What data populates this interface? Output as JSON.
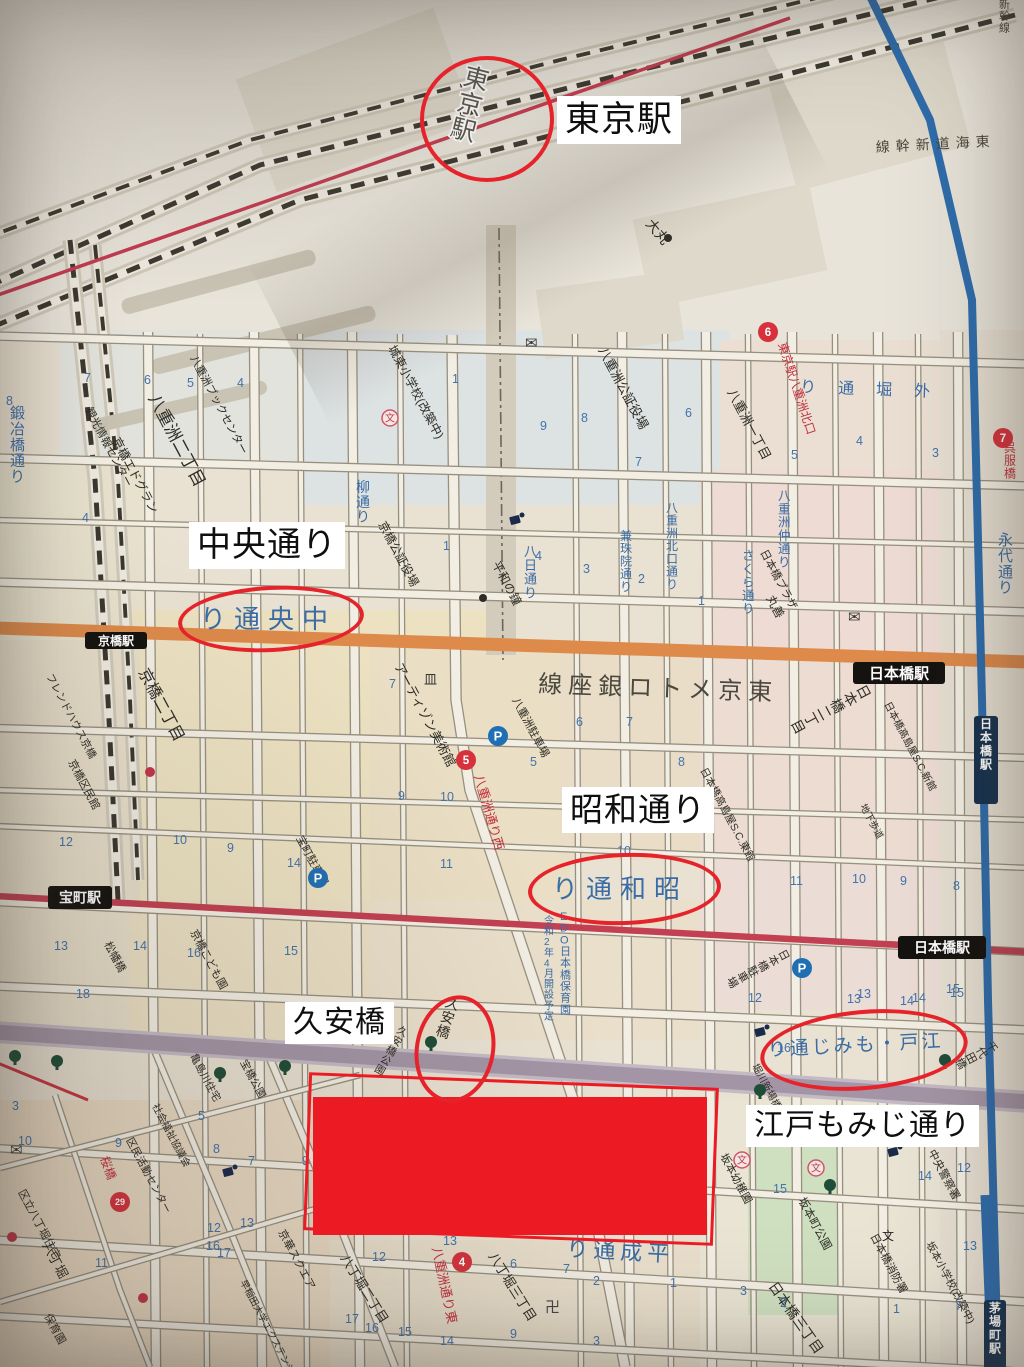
{
  "annotations": {
    "tokyo_station": "東京駅",
    "chuo_dori": "中央通り",
    "showa_dori": "昭和通り",
    "kyuan_bashi": "久安橋",
    "edo_momiji_dori": "江戸もみじ通り"
  },
  "colors": {
    "annotation_red": "#e6232b",
    "redaction_red": "#ec1a23",
    "road_orange": "#dd8a4b",
    "line_crimson": "#c24052",
    "expressway_purple": "#a495a6",
    "line_blue": "#2e6cac",
    "label_blue": "#3a6ca6",
    "label_black": "#2e2c26",
    "label_red": "#c2303c",
    "paper": "#e9e1d2"
  },
  "map": {
    "stations": [
      {
        "t": "京橋駅",
        "x": 85,
        "y": 632,
        "w": 62,
        "h": 17,
        "fs": 12
      },
      {
        "t": "日本橋駅",
        "x": 853,
        "y": 662,
        "w": 92,
        "h": 22,
        "fs": 15
      },
      {
        "t": "宝町駅",
        "x": 48,
        "y": 886,
        "w": 64,
        "h": 23,
        "fs": 14
      },
      {
        "t": "日本橋駅",
        "x": 898,
        "y": 936,
        "w": 88,
        "h": 23,
        "fs": 14
      },
      {
        "t": "日本橋駅",
        "x": 974,
        "y": 716,
        "w": 24,
        "h": 88,
        "fs": 12,
        "v": 1,
        "bg": "#16324f"
      },
      {
        "t": "茅場町駅",
        "x": 984,
        "y": 1300,
        "w": 22,
        "h": 80,
        "fs": 12,
        "v": 1,
        "bg": "#16324f"
      }
    ],
    "blue_labels": [
      {
        "t": "中央通り",
        "x": 200,
        "y": 628,
        "fs": 26,
        "rtl": 1,
        "ls": 8
      },
      {
        "t": "昭和通り",
        "x": 552,
        "y": 898,
        "fs": 26,
        "rtl": 1,
        "ls": 8
      },
      {
        "t": "江戸・もみじ通り",
        "x": 768,
        "y": 1056,
        "fs": 19,
        "rtl": 1,
        "ls": 3,
        "r": -3
      },
      {
        "t": "外堀通り",
        "x": 800,
        "y": 392,
        "fs": 16,
        "rtl": 1,
        "ls": 22,
        "r": 2
      },
      {
        "t": "平成通り",
        "x": 566,
        "y": 1256,
        "fs": 22,
        "rtl": 1,
        "ls": 5,
        "r": 3
      },
      {
        "t": "鍛冶橋通り",
        "x": 10,
        "y": 418,
        "fs": 15,
        "v": 1
      },
      {
        "t": "柳通り",
        "x": 356,
        "y": 492,
        "fs": 14,
        "v": 1
      },
      {
        "t": "八日通り",
        "x": 524,
        "y": 556,
        "fs": 13,
        "v": 1
      },
      {
        "t": "兼珠院通り",
        "x": 620,
        "y": 540,
        "fs": 12,
        "v": 1
      },
      {
        "t": "八重洲北口通り",
        "x": 666,
        "y": 512,
        "fs": 12,
        "v": 1
      },
      {
        "t": "さくら通り",
        "x": 742,
        "y": 560,
        "fs": 12.5,
        "v": 1
      },
      {
        "t": "八重洲仲通り",
        "x": 778,
        "y": 500,
        "fs": 12.5,
        "v": 1
      },
      {
        "t": "永代通り",
        "x": 998,
        "y": 545,
        "fs": 15,
        "v": 1
      },
      {
        "t": "EDO日本橋保育園",
        "x": 560,
        "y": 920,
        "fs": 11,
        "v": 1
      },
      {
        "t": "令和2年4月開設予定",
        "x": 544,
        "y": 924,
        "fs": 10,
        "v": 1
      }
    ],
    "dark_labels": [
      {
        "t": "東京メトロ銀座線",
        "x": 538,
        "y": 692,
        "fs": 24,
        "rtl": 1,
        "ls": 6,
        "r": 2
      },
      {
        "t": "東海道新幹線",
        "x": 876,
        "y": 152,
        "fs": 14,
        "rtl": 1,
        "ls": 6,
        "r": -3
      },
      {
        "t": "新幹線",
        "x": 999,
        "y": 8,
        "fs": 11,
        "v": 1
      },
      {
        "t": "東京駅",
        "x": 462,
        "y": 84,
        "fs": 25,
        "v": 1,
        "o": 1,
        "r": 14
      }
    ],
    "red_labels": [
      {
        "t": "東京駅八重洲北口",
        "x": 778,
        "y": 344,
        "fs": 12,
        "r": 72
      },
      {
        "t": "八重洲通り西",
        "x": 474,
        "y": 776,
        "fs": 13,
        "r": 74
      },
      {
        "t": "八重洲通り東",
        "x": 432,
        "y": 1248,
        "fs": 13,
        "r": 78
      },
      {
        "t": "桜橋",
        "x": 100,
        "y": 1158,
        "fs": 12,
        "r": 70
      },
      {
        "t": "呉服橋",
        "x": 1004,
        "y": 452,
        "fs": 12,
        "v": 1
      }
    ],
    "poi_labels": [
      {
        "t": "八重洲二丁目",
        "x": 148,
        "y": 398,
        "fs": 17
      },
      {
        "t": "八重洲ブックセンター",
        "x": 190,
        "y": 358,
        "fs": 11
      },
      {
        "t": "城東小学校(改築中)",
        "x": 388,
        "y": 348,
        "fs": 12
      },
      {
        "t": "八重洲公証役場",
        "x": 598,
        "y": 350,
        "fs": 13
      },
      {
        "t": "八重洲一丁目",
        "x": 727,
        "y": 392,
        "fs": 13
      },
      {
        "t": "大丸",
        "x": 645,
        "y": 224,
        "fs": 14,
        "r": 50
      },
      {
        "t": "観光情報センター",
        "x": 85,
        "y": 410,
        "fs": 11
      },
      {
        "t": "京橋エドグラン",
        "x": 112,
        "y": 440,
        "fs": 12
      },
      {
        "t": "京橋公証役場",
        "x": 378,
        "y": 524,
        "fs": 12
      },
      {
        "t": "平和の鐘",
        "x": 492,
        "y": 564,
        "fs": 12
      },
      {
        "t": "フレンドハウス京橋",
        "x": 46,
        "y": 676,
        "fs": 10.5
      },
      {
        "t": "京橋二丁目",
        "x": 138,
        "y": 672,
        "fs": 16
      },
      {
        "t": "京橋区民館",
        "x": 68,
        "y": 762,
        "fs": 11
      },
      {
        "t": "アーティゾン美術館",
        "x": 394,
        "y": 666,
        "fs": 13
      },
      {
        "t": "八重洲駐車場",
        "x": 512,
        "y": 700,
        "fs": 11
      },
      {
        "t": "宝町駐車場",
        "x": 296,
        "y": 838,
        "fs": 11
      },
      {
        "t": "日本橋プラザ",
        "x": 760,
        "y": 552,
        "fs": 11
      },
      {
        "t": "丸善",
        "x": 766,
        "y": 598,
        "fs": 12
      },
      {
        "t": "日本橋二丁目",
        "x": 856,
        "y": 688,
        "fs": 14,
        "v": 1
      },
      {
        "t": "日本橋高島屋S.C.新館",
        "x": 884,
        "y": 704,
        "fs": 10
      },
      {
        "t": "日本橋高島屋S.C.東館",
        "x": 700,
        "y": 770,
        "fs": 10.5
      },
      {
        "t": "地下歩道",
        "x": 860,
        "y": 806,
        "fs": 9.5
      },
      {
        "t": "日本橋駐車場",
        "x": 778,
        "y": 952,
        "fs": 11,
        "v": 1
      },
      {
        "t": "京橋こども園",
        "x": 190,
        "y": 932,
        "fs": 11
      },
      {
        "t": "松幡橋",
        "x": 104,
        "y": 944,
        "fs": 11
      },
      {
        "t": "久安橋",
        "x": 444,
        "y": 1006,
        "fs": 14,
        "r": 18,
        "v": 1
      },
      {
        "t": "久安橋公園",
        "x": 396,
        "y": 1032,
        "fs": 10.5,
        "r": 30,
        "v": 1
      },
      {
        "t": "宝橋公園",
        "x": 240,
        "y": 1062,
        "fs": 10.5
      },
      {
        "t": "亀島川住宅",
        "x": 190,
        "y": 1056,
        "fs": 10.5
      },
      {
        "t": "社会福祉協議会",
        "x": 152,
        "y": 1106,
        "fs": 10
      },
      {
        "t": "区民活動センター",
        "x": 126,
        "y": 1140,
        "fs": 10.5
      },
      {
        "t": "区立八丁堀住宅",
        "x": 18,
        "y": 1192,
        "fs": 11
      },
      {
        "t": "八丁堀",
        "x": 42,
        "y": 1245,
        "fs": 13
      },
      {
        "t": "保育園",
        "x": 44,
        "y": 1316,
        "fs": 11
      },
      {
        "t": "京華スクエア",
        "x": 278,
        "y": 1232,
        "fs": 11
      },
      {
        "t": "早稲田大学エクステンションセンター",
        "x": 240,
        "y": 1282,
        "fs": 9.5
      },
      {
        "t": "八丁堀二丁目",
        "x": 340,
        "y": 1258,
        "fs": 13,
        "r": 58
      },
      {
        "t": "八丁堀三丁目",
        "x": 488,
        "y": 1256,
        "fs": 13,
        "r": 58
      },
      {
        "t": "日本橋三丁目",
        "x": 768,
        "y": 1286,
        "fs": 14,
        "r": 55
      },
      {
        "t": "坂本幼稚園",
        "x": 720,
        "y": 1156,
        "fs": 11
      },
      {
        "t": "坂本町公園",
        "x": 798,
        "y": 1200,
        "fs": 11.5
      },
      {
        "t": "坂本小学校(改築中)",
        "x": 926,
        "y": 1244,
        "fs": 10.5
      },
      {
        "t": "日本橋消防署",
        "x": 870,
        "y": 1236,
        "fs": 11
      },
      {
        "t": "中央警察署",
        "x": 928,
        "y": 1152,
        "fs": 11
      },
      {
        "t": "千代田橋",
        "x": 986,
        "y": 1044,
        "fs": 11,
        "v": 1
      },
      {
        "t": "堀川新場橋公園",
        "x": 752,
        "y": 1066,
        "fs": 10
      }
    ],
    "red_badges": [
      [
        "5",
        466,
        760
      ],
      [
        "4",
        462,
        1262
      ],
      [
        "6",
        768,
        332
      ],
      [
        "7",
        1003,
        438
      ],
      [
        "29",
        120,
        1202
      ]
    ],
    "parking_badges": [
      [
        318,
        878
      ],
      [
        498,
        736
      ],
      [
        802,
        968
      ]
    ],
    "block_numbers": [
      [
        8,
        6,
        405
      ],
      [
        7,
        84,
        382
      ],
      [
        6,
        144,
        384
      ],
      [
        5,
        187,
        387
      ],
      [
        4,
        237,
        387
      ],
      [
        4,
        82,
        522
      ],
      [
        1,
        452,
        383
      ],
      [
        9,
        540,
        430
      ],
      [
        8,
        581,
        422
      ],
      [
        7,
        635,
        466
      ],
      [
        6,
        685,
        417
      ],
      [
        5,
        791,
        459
      ],
      [
        4,
        856,
        445
      ],
      [
        3,
        932,
        457
      ],
      [
        4,
        535,
        560
      ],
      [
        3,
        583,
        573
      ],
      [
        2,
        638,
        583
      ],
      [
        1,
        698,
        605
      ],
      [
        1,
        443,
        550
      ],
      [
        7,
        389,
        688
      ],
      [
        9,
        398,
        800
      ],
      [
        10,
        440,
        801
      ],
      [
        5,
        530,
        766
      ],
      [
        6,
        576,
        726
      ],
      [
        7,
        626,
        726
      ],
      [
        8,
        678,
        766
      ],
      [
        11,
        440,
        868
      ],
      [
        10,
        617,
        855
      ],
      [
        12,
        59,
        846
      ],
      [
        10,
        173,
        844
      ],
      [
        9,
        227,
        852
      ],
      [
        14,
        287,
        867
      ],
      [
        13,
        54,
        950
      ],
      [
        14,
        133,
        950
      ],
      [
        16,
        187,
        957
      ],
      [
        15,
        284,
        955
      ],
      [
        18,
        76,
        998
      ],
      [
        11,
        790,
        885
      ],
      [
        10,
        852,
        883
      ],
      [
        9,
        900,
        885
      ],
      [
        8,
        953,
        890
      ],
      [
        13,
        857,
        998
      ],
      [
        14,
        912,
        1002
      ],
      [
        15,
        950,
        997
      ],
      [
        12,
        748,
        1002
      ],
      [
        13,
        847,
        1003
      ],
      [
        14,
        900,
        1005
      ],
      [
        15,
        946,
        993
      ],
      [
        16,
        777,
        1052
      ],
      [
        3,
        12,
        1110
      ],
      [
        10,
        18,
        1145
      ],
      [
        5,
        198,
        1120
      ],
      [
        8,
        213,
        1153
      ],
      [
        7,
        248,
        1165
      ],
      [
        9,
        302,
        1165
      ],
      [
        13,
        240,
        1227
      ],
      [
        12,
        207,
        1232
      ],
      [
        16,
        206,
        1250
      ],
      [
        17,
        217,
        1257
      ],
      [
        11,
        95,
        1267
      ],
      [
        9,
        115,
        1147
      ],
      [
        12,
        372,
        1261
      ],
      [
        13,
        443,
        1245
      ],
      [
        15,
        398,
        1336
      ],
      [
        14,
        440,
        1345
      ],
      [
        16,
        365,
        1332
      ],
      [
        17,
        345,
        1323
      ],
      [
        6,
        510,
        1268
      ],
      [
        9,
        510,
        1338
      ],
      [
        1,
        670,
        1287
      ],
      [
        2,
        593,
        1285
      ],
      [
        3,
        593,
        1345
      ],
      [
        7,
        563,
        1273
      ],
      [
        15,
        773,
        1193
      ],
      [
        12,
        957,
        1172
      ],
      [
        13,
        963,
        1250
      ],
      [
        3,
        740,
        1295
      ],
      [
        2,
        780,
        1307
      ],
      [
        1,
        893,
        1313
      ],
      [
        7,
        955,
        1310
      ],
      [
        14,
        918,
        1180
      ]
    ],
    "symbols": {
      "mail": [
        [
          525,
          348
        ],
        [
          848,
          622
        ],
        [
          10,
          1155
        ]
      ],
      "manji": [
        [
          545,
          1312
        ]
      ],
      "museum": [
        [
          424,
          684
        ]
      ],
      "black_dots": [
        [
          483,
          598
        ],
        [
          668,
          238
        ]
      ],
      "red_dots": [
        [
          150,
          772
        ],
        [
          12,
          1237
        ],
        [
          143,
          1298
        ]
      ],
      "trees": [
        [
          57,
          1063
        ],
        [
          220,
          1075
        ],
        [
          285,
          1068
        ],
        [
          431,
          1044
        ],
        [
          830,
          1187
        ],
        [
          945,
          1062
        ],
        [
          15,
          1058
        ],
        [
          760,
          1092
        ]
      ],
      "cams": [
        [
          515,
          520
        ],
        [
          893,
          1152
        ],
        [
          228,
          1172
        ],
        [
          760,
          1032
        ]
      ],
      "school_circles": [
        [
          390,
          418
        ],
        [
          742,
          1160
        ],
        [
          816,
          1168
        ]
      ],
      "school_dark": [
        [
          882,
          1240
        ]
      ]
    }
  }
}
